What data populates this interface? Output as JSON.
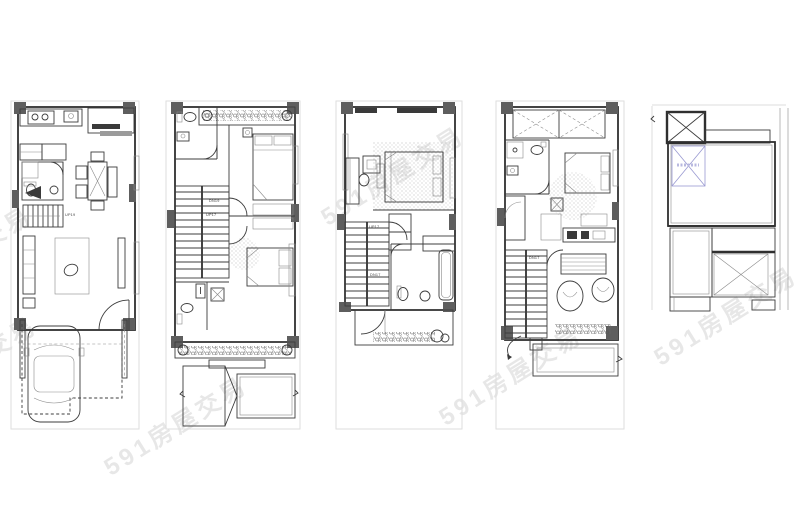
{
  "sheet": {
    "description": "five stacked townhouse floor plans, left to right: ground floor with carport, second floor, third floor, fourth floor, roof plan"
  },
  "watermark": {
    "text": "591房屋交易"
  },
  "plans": [
    {
      "name": "ground-floor",
      "stairs": {
        "label": "UP19"
      }
    },
    {
      "name": "second-floor",
      "stairs": {
        "down_label": "DN19",
        "up_label": "UP17"
      }
    },
    {
      "name": "third-floor",
      "stairs": {
        "up_label": "UP17",
        "down_label": "DN17"
      }
    },
    {
      "name": "fourth-floor",
      "stairs": {
        "down_label": "DN17"
      }
    },
    {
      "name": "roof"
    }
  ],
  "colors": {
    "paper": "#ffffff",
    "wall": "#2f2f2f",
    "column": "#5e5e5e",
    "site_line": "#dedede",
    "skylight_blue": "#9a9ad2",
    "watermark": "#c8c8c8"
  }
}
